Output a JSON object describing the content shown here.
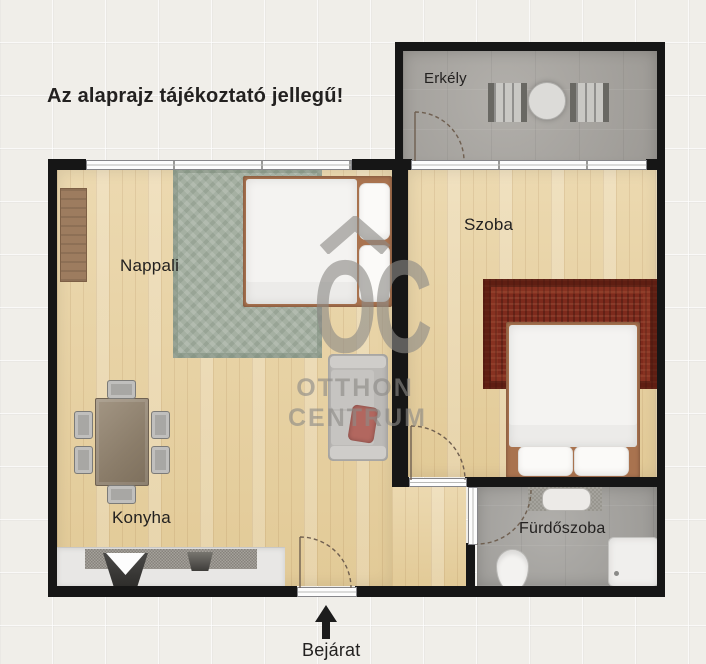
{
  "disclaimer": "Az alaprajz tájékoztató jellegű!",
  "rooms": {
    "balcony": {
      "label": "Erkély"
    },
    "bedroom": {
      "label": "Szoba"
    },
    "living_room": {
      "label": "Nappali"
    },
    "kitchen": {
      "label": "Konyha"
    },
    "bathroom": {
      "label": "Fürdőszoba"
    }
  },
  "entrance": {
    "label": "Bejárat"
  },
  "watermark": {
    "monogram": "OC",
    "name_line1": "OTTHON",
    "name_line2": "CENTRUM"
  },
  "colors": {
    "background": "#f0eee9",
    "wall": "#161616",
    "wood_floor": "#e9d3a6",
    "balcony_floor": "#a9a6a1",
    "bathroom_floor": "#a7a5a1",
    "living_rug": "#a5b0a2",
    "bedroom_rug": "#7d2a1c",
    "bed_frame": "#a9734f",
    "watermark_gray": "#8d8b87",
    "label_text": "#232120"
  }
}
